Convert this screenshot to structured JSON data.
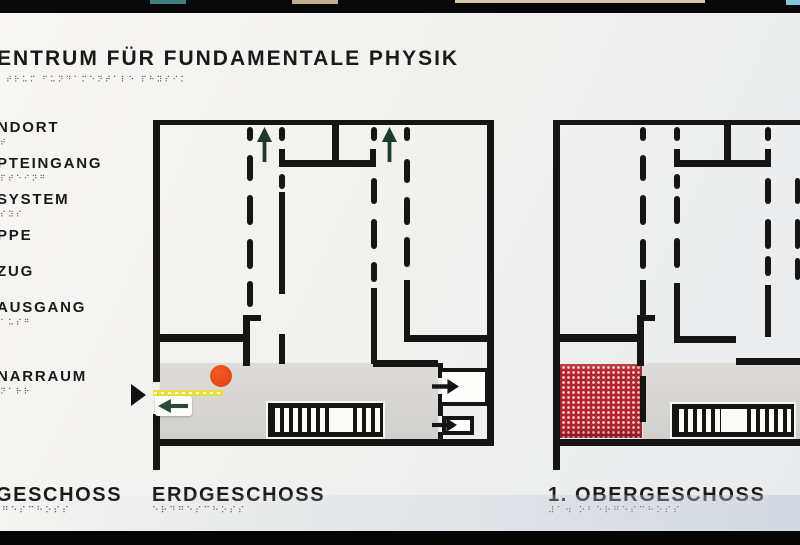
{
  "sign": {
    "colors": {
      "wall": "#161514",
      "panel": "#f1f1ef",
      "corridor_gray": "#d8d7d3",
      "location_dot_red": "#e64b1e",
      "guide_strip_yellow": "#e9de3d",
      "entry_arrow_green": "#2b4a38",
      "up_arrow_green": "#1e3a2c",
      "highlight_area_red": "#b2232e",
      "frame_black": "#080808"
    },
    "title": {
      "text": "ENTRUM FÜR FUNDAMENTALE PHYSIK",
      "braille": "⠞⠗⠥⠍ ⠋⠥⠝⠙⠁⠍⠑⠝⠞⠁⠇⠑ ⠏⠓⠽⠎⠊⠅"
    },
    "legend": {
      "items": [
        {
          "label": "NDORT",
          "braille": "⠞",
          "y": 106
        },
        {
          "label": "PTEINGANG",
          "braille": "⠏⠞⠑⠊⠝⠛",
          "y": 142
        },
        {
          "label": "SYSTEM",
          "braille": "⠎⠽⠎",
          "y": 178
        },
        {
          "label": "PPE",
          "braille": "",
          "y": 214
        },
        {
          "label": "ZUG",
          "braille": "",
          "y": 250
        },
        {
          "label": "AUSGANG",
          "braille": "⠁⠥⠎⠛",
          "y": 286
        },
        {
          "label": "NARRAUM",
          "braille": "⠝⠁⠗⠗",
          "y": 355
        }
      ]
    },
    "floor_labels": [
      {
        "text": "GESCHOSS",
        "braille": "⠛⠑⠎⠉⠓⠕⠎⠎",
        "x": -4,
        "y": 471
      },
      {
        "text": "ERDGESCHOSS",
        "braille": "⠑⠗⠙⠛⠑⠎⠉⠓⠕⠎⠎",
        "x": 152,
        "y": 471
      },
      {
        "text": "1. OBERGESCHOSS",
        "braille": "⠼⠁⠲ ⠕⠃⠑⠗⠛⠑⠎⠉⠓⠕⠎⠎",
        "x": 548,
        "y": 471
      }
    ],
    "marker": {
      "name": "you-are-here-pointer",
      "x": 131,
      "y": 371
    },
    "plans": [
      {
        "id": "erdgeschoss",
        "x": 148,
        "y": 105,
        "w": 349,
        "h": 352,
        "corridor": [
          12,
          245,
          278,
          76
        ],
        "red_area": null,
        "walls": [
          [
            5,
            2,
            341,
            5
          ],
          [
            339,
            2,
            7,
            326
          ],
          [
            5,
            321,
            341,
            7
          ],
          [
            5,
            2,
            7,
            262
          ],
          [
            5,
            296,
            7,
            56
          ],
          [
            12,
            216,
            85,
            8
          ],
          [
            95,
            197,
            7,
            51
          ],
          [
            95,
            197,
            18,
            6
          ],
          [
            184,
            2,
            7,
            44
          ],
          [
            131,
            42,
            97,
            7
          ],
          [
            131,
            31,
            6,
            18
          ],
          [
            222,
            31,
            6,
            18
          ],
          [
            131,
            74,
            6,
            102
          ],
          [
            131,
            216,
            6,
            30
          ],
          [
            223,
            170,
            6,
            76
          ],
          [
            256,
            162,
            6,
            62
          ],
          [
            256,
            217,
            89,
            7
          ],
          [
            225,
            242,
            65,
            7
          ],
          [
            290,
            245,
            5,
            15
          ],
          [
            290,
            276,
            5,
            22
          ],
          [
            290,
            314,
            5,
            8
          ]
        ],
        "dashes": [
          [
            99,
            9,
            6,
            14
          ],
          [
            99,
            37,
            6,
            26
          ],
          [
            99,
            77,
            6,
            30
          ],
          [
            99,
            121,
            6,
            30
          ],
          [
            99,
            163,
            6,
            26
          ],
          [
            131,
            9,
            6,
            14
          ],
          [
            131,
            56,
            6,
            15
          ],
          [
            223,
            9,
            6,
            14
          ],
          [
            223,
            60,
            6,
            26
          ],
          [
            223,
            101,
            6,
            30
          ],
          [
            223,
            144,
            6,
            20
          ],
          [
            256,
            9,
            6,
            14
          ],
          [
            256,
            41,
            6,
            24
          ],
          [
            256,
            79,
            6,
            28
          ],
          [
            256,
            119,
            6,
            30
          ]
        ],
        "up_arrows": [
          [
            108,
            9,
            17,
            36
          ],
          [
            233,
            9,
            17,
            36
          ]
        ],
        "stairs": {
          "x": 120,
          "y": 285,
          "w": 115,
          "h": 34,
          "left": 62,
          "gap": 20,
          "right": 27
        },
        "location_dot": [
          62,
          247,
          22
        ],
        "guide_strip": [
          5,
          272,
          70,
          6
        ],
        "entry": {
          "plate": [
            7,
            278,
            37,
            20
          ],
          "arrow": [
            10,
            281,
            30,
            14
          ]
        },
        "elevators": [
          {
            "box": [
              294,
              250,
              47,
              38
            ],
            "open_left": true,
            "arrow": [
              284,
              261,
              27,
              15
            ]
          },
          {
            "box": [
              294,
              298,
              32,
              19
            ],
            "open_left": false,
            "arrow": [
              284,
              300,
              25,
              14
            ]
          }
        ]
      },
      {
        "id": "obergeschoss-1",
        "x": 548,
        "y": 105,
        "w": 252,
        "h": 352,
        "corridor": [
          95,
          245,
          157,
          76
        ],
        "red_area": [
          7,
          246,
          87,
          74
        ],
        "walls": [
          [
            5,
            2,
            247,
            5
          ],
          [
            5,
            2,
            7,
            326
          ],
          [
            5,
            328,
            7,
            24
          ],
          [
            5,
            321,
            247,
            7
          ],
          [
            12,
            216,
            79,
            8
          ],
          [
            89,
            197,
            7,
            51
          ],
          [
            89,
            197,
            18,
            6
          ],
          [
            176,
            2,
            7,
            44
          ],
          [
            126,
            42,
            97,
            7
          ],
          [
            126,
            31,
            6,
            18
          ],
          [
            217,
            31,
            6,
            18
          ],
          [
            92,
            162,
            6,
            36
          ],
          [
            126,
            165,
            6,
            60
          ],
          [
            126,
            218,
            62,
            7
          ],
          [
            217,
            167,
            6,
            52
          ],
          [
            188,
            240,
            64,
            7
          ],
          [
            92,
            258,
            6,
            46
          ]
        ],
        "dashes": [
          [
            92,
            9,
            6,
            14
          ],
          [
            92,
            37,
            6,
            26
          ],
          [
            92,
            77,
            6,
            30
          ],
          [
            92,
            121,
            6,
            30
          ],
          [
            126,
            9,
            6,
            14
          ],
          [
            126,
            56,
            6,
            15
          ],
          [
            126,
            78,
            6,
            28
          ],
          [
            126,
            120,
            6,
            30
          ],
          [
            217,
            9,
            6,
            14
          ],
          [
            217,
            60,
            6,
            26
          ],
          [
            217,
            101,
            6,
            30
          ],
          [
            217,
            138,
            6,
            20
          ],
          [
            247,
            60,
            5,
            26
          ],
          [
            247,
            101,
            5,
            30
          ],
          [
            247,
            140,
            5,
            22
          ]
        ],
        "up_arrows": [],
        "stairs": {
          "x": 124,
          "y": 286,
          "w": 122,
          "h": 33,
          "left": 46,
          "gap": 26,
          "right": 44
        },
        "location_dot": null,
        "guide_strip": null,
        "entry": null,
        "elevators": []
      }
    ]
  }
}
